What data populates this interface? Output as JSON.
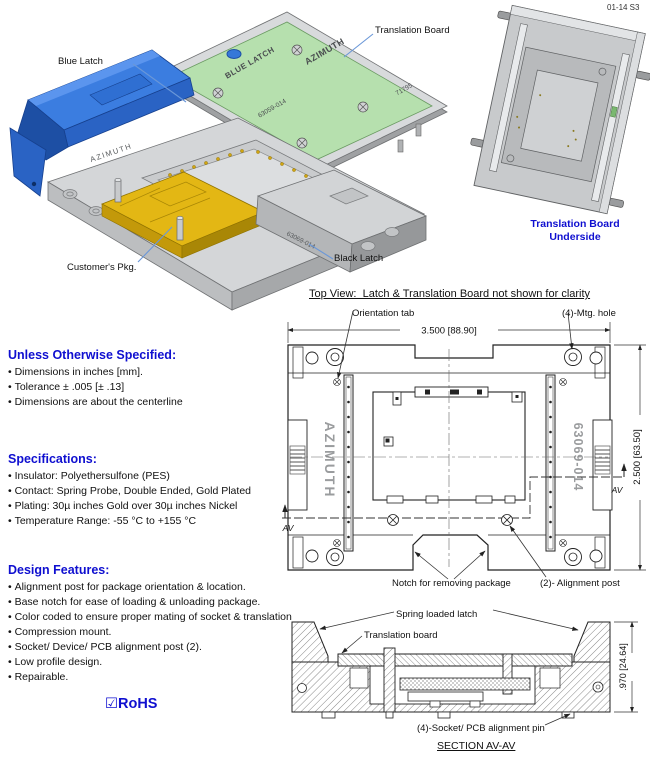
{
  "doc": {
    "code": "01-14 S3"
  },
  "colors": {
    "accent_blue": "#0f0fd0",
    "leader_blue": "#6a97d8",
    "latch_blue": "#2f6fd2",
    "board_green": "#b6e0ae",
    "package_gold": "#e3b714",
    "body_gray": "#d4d6d8"
  },
  "iso_view": {
    "callouts": {
      "blue_latch": "Blue Latch",
      "translation_board": "Translation Board",
      "customers_pkg": "Customer's Pkg.",
      "black_latch": "Black Latch"
    },
    "board_markings": {
      "latch_color": "BLUE LATCH",
      "brand": "AZIMUTH",
      "part_no": "63059-014",
      "lot_no": "71795"
    },
    "socket_markings": {
      "brand": "AZIMUTH",
      "part_no": "63069-014"
    }
  },
  "underside_view": {
    "caption_line1": "Translation Board",
    "caption_line2": "Underside"
  },
  "notes": [
    {
      "heading": "Unless Otherwise Specified:",
      "items": [
        "Dimensions in inches [mm].",
        "Tolerance ± .005 [± .13]",
        "Dimensions are about the centerline"
      ]
    },
    {
      "heading": "Specifications:",
      "items": [
        "Insulator: Polyethersulfone (PES)",
        "Contact: Spring Probe, Double Ended, Gold Plated",
        "Plating: 30µ inches Gold over 30µ inches Nickel",
        "Temperature Range: -55 °C to +155 °C"
      ]
    },
    {
      "heading": "Design Features:",
      "items": [
        "Alignment post for package orientation & location.",
        "Base notch for ease of loading & unloading package.",
        "Color coded to ensure proper mating of socket & translation",
        "Compression mount.",
        "Socket/ Device/ PCB alignment post (2).",
        "Low profile design.",
        "Repairable."
      ]
    }
  ],
  "rohs_label": "☑RoHS",
  "top_view": {
    "title": "Top View:  Latch & Translation Board not shown for clarity",
    "callouts": {
      "orientation_tab": "Orientation tab",
      "mtg_hole": "(4)-Mtg. hole",
      "notch": "Notch for removing package",
      "alignment_post": "(2)- Alignment post"
    },
    "dim_width": "3.500 [88.90]",
    "dim_height": "2.500 [63.50]",
    "marking_brand": "AZIMUTH",
    "marking_part": "63069-014",
    "section_label": "AV"
  },
  "section_view": {
    "title": "SECTION AV-AV",
    "callouts": {
      "spring_latch": "Spring loaded latch",
      "translation_board": "Translation board",
      "alignment_pin": "(4)-Socket/ PCB alignment pin"
    },
    "dim_height": ".970 [24.64]"
  }
}
